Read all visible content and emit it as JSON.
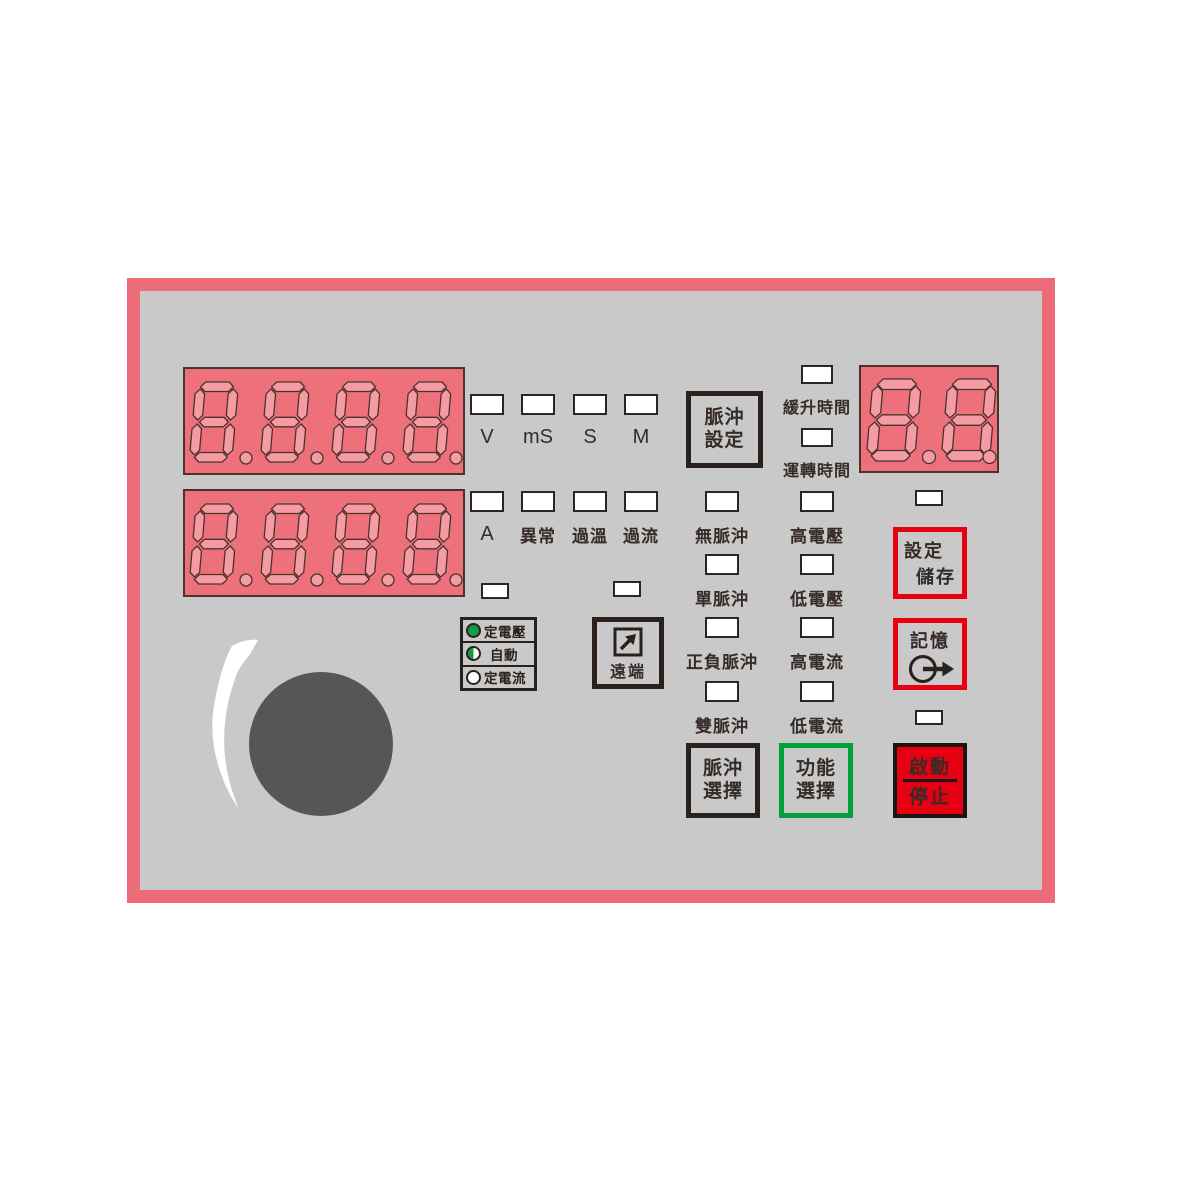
{
  "panel": {
    "type": "pulse-power-supply-front-panel"
  },
  "displays": {
    "upper": {
      "value": "8.8.8.8.",
      "digits": 4,
      "description": "upper seven-segment readout, all segments shown"
    },
    "lower": {
      "value": "8.8.8.8.",
      "digits": 4,
      "description": "lower seven-segment readout, all segments shown"
    },
    "memory": {
      "value": "8.8.",
      "digits": 2,
      "description": "memory number seven-segment readout"
    }
  },
  "unit_indicators": [
    {
      "label": "V"
    },
    {
      "label": "mS"
    },
    {
      "label": "S"
    },
    {
      "label": "M"
    }
  ],
  "status_indicators": [
    {
      "label": "A"
    },
    {
      "label": "異常"
    },
    {
      "label": "過溫"
    },
    {
      "label": "過流"
    }
  ],
  "time_indicators": [
    {
      "label": "緩升時間"
    },
    {
      "label": "運轉時間"
    }
  ],
  "pulse_mode_indicators": [
    {
      "label": "無脈沖"
    },
    {
      "label": "單脈沖"
    },
    {
      "label": "正負脈沖"
    },
    {
      "label": "雙脈沖"
    }
  ],
  "level_indicators": [
    {
      "label": "高電壓"
    },
    {
      "label": "低電壓"
    },
    {
      "label": "高電流"
    },
    {
      "label": "低電流"
    }
  ],
  "regulation_leds": [
    {
      "label": "定電壓",
      "state": "on"
    },
    {
      "label": "自動",
      "state": "half"
    },
    {
      "label": "定電流",
      "state": "off"
    }
  ],
  "buttons": {
    "pulse_setting": {
      "line1": "脈沖",
      "line2": "設定"
    },
    "remote": {
      "label": "遠端"
    },
    "set_store": {
      "label_top": "設定",
      "label_bottom": "儲存"
    },
    "memory": {
      "label": "記憶"
    },
    "pulse_select": {
      "line1": "脈沖",
      "line2": "選擇"
    },
    "function_select": {
      "line1": "功能",
      "line2": "選擇"
    },
    "start_stop": {
      "label_top": "啟動",
      "label_bottom": "停止"
    }
  },
  "colors": {
    "panel_border": "#ec6d79",
    "panel_bg": "#c9c9c9",
    "display_bg": "#ee707b",
    "segment_fill": "#f49ba3",
    "segment_outline": "#4a332d",
    "accent_red": "#e60012",
    "accent_green": "#00a23e",
    "button_dark": "#2b211c",
    "led_green": "#149a46",
    "knob_gray": "#585655",
    "text": "#352c27"
  }
}
